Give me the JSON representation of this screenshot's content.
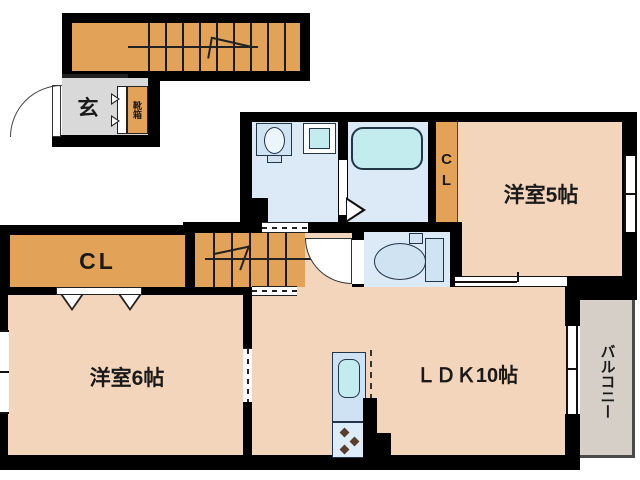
{
  "colors": {
    "wall": "#000000",
    "room": "#f2d5ba",
    "orange": "#e2a258",
    "sanitary": "#dceaf7",
    "fixture_fill": "#cfe3f3",
    "cyan": "#c2ecee",
    "genkan": "#d9d9d9",
    "balcony": "#d6cfc8",
    "kitchen_lower": "#dcecf8",
    "burner": "#5a3d2b"
  },
  "rooms": {
    "genkan": {
      "label": "玄"
    },
    "shoe_cabinet": {
      "label": "靴箱"
    },
    "closet_upper": {
      "label": "CL"
    },
    "western_room_5": {
      "label": "洋室5帖"
    },
    "closet_left": {
      "label": "CL"
    },
    "western_room_6": {
      "label": "洋室6帖"
    },
    "ldk": {
      "label": "ＬＤＫ10帖"
    },
    "balcony": {
      "label": "バルコニー"
    }
  }
}
